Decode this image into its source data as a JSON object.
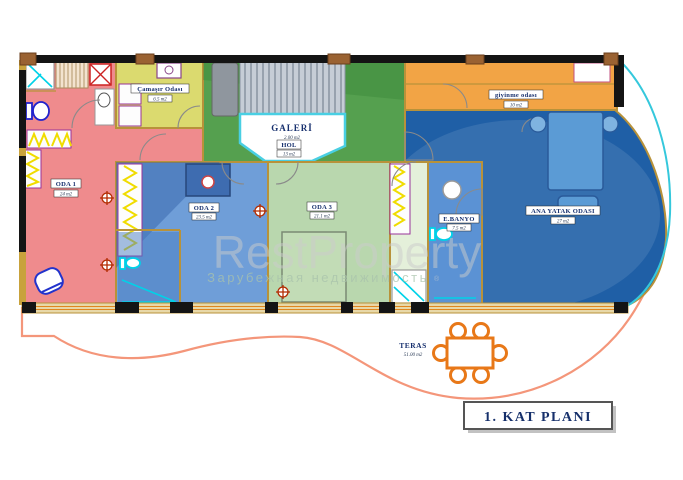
{
  "title_block": {
    "label": "1. KAT PLANI"
  },
  "watermark": {
    "brand": "RestProperty",
    "subtitle": "Зарубежная недвижимость",
    "reg": "®",
    "brand_color": "#cccccc",
    "subtitle_color": "#a9c3ac"
  },
  "rooms": [
    {
      "id": "oda-1",
      "name": "ODA 1",
      "area": "24 m2",
      "color": "#ef8b8d"
    },
    {
      "id": "camasir-odasi",
      "name": "Çamaşır Odası",
      "area": "6.5 m2",
      "color": "#dbda6f"
    },
    {
      "id": "galeri",
      "name": "GALERİ",
      "area": "2.00 m2",
      "color": "#ffffff"
    },
    {
      "id": "hol",
      "name": "HOL",
      "area": "13 m2",
      "color": "#55a04f"
    },
    {
      "id": "oda-2",
      "name": "ODA 2",
      "area": "23.5 m2",
      "color": "#6f9ed8"
    },
    {
      "id": "oda-3",
      "name": "ODA 3",
      "area": "21.1 m2",
      "color": "#b9d7ae"
    },
    {
      "id": "e-banyo",
      "name": "E.BANYO",
      "area": "7.5 m2",
      "color": "#5b92d4"
    },
    {
      "id": "giyinme-odasi",
      "name": "giyinme odası",
      "area": "10 m2",
      "color": "#f2a445"
    },
    {
      "id": "ana-yatak-odasi",
      "name": "ANA YATAK ODASI",
      "area": "27 m2",
      "color": "#1f5fa6"
    },
    {
      "id": "teras",
      "name": "TERAS",
      "area": "51.00 m2",
      "color": "#ffffff"
    }
  ],
  "palette": {
    "wall_tan": "#b8923a",
    "wall_dark": "#141414",
    "terrace_line": "#f4967a",
    "curve_accent": "#35c8dc",
    "furniture_orange": "#e87818",
    "title_navy": "#16306b",
    "label_navy": "#17306e",
    "corridor": "#e4f0da",
    "fixture_cyan": "#00d2e8",
    "wardrobe_yellow": "#f0dc00"
  }
}
